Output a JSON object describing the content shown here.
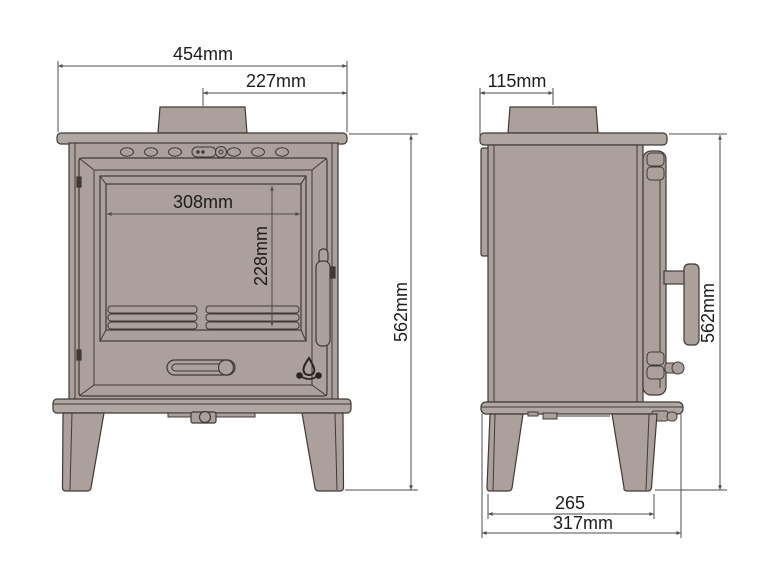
{
  "drawing": {
    "type": "technical-dimension-diagram",
    "subject": "wood burning stove - front and side elevation with dimensions",
    "colors": {
      "body_fill": "#aba09c",
      "plate_fill": "#b1a7a2",
      "outline": "#403935",
      "dimension_line": "#4c4c4c",
      "text": "#1c1c1c",
      "logo": "#2b2522",
      "background": "#ffffff"
    },
    "icons": {
      "flame_logo": "campfire-flame-brand-mark"
    },
    "front_view": {
      "overall_width": "454mm",
      "flue_centre_from_side": "227mm",
      "glass_width": "308mm",
      "glass_height": "228mm",
      "overall_height": "562mm"
    },
    "side_view": {
      "flue_centre_from_front": "115mm",
      "overall_height": "562mm",
      "leg_clearance": "265",
      "overall_depth": "317mm"
    }
  }
}
